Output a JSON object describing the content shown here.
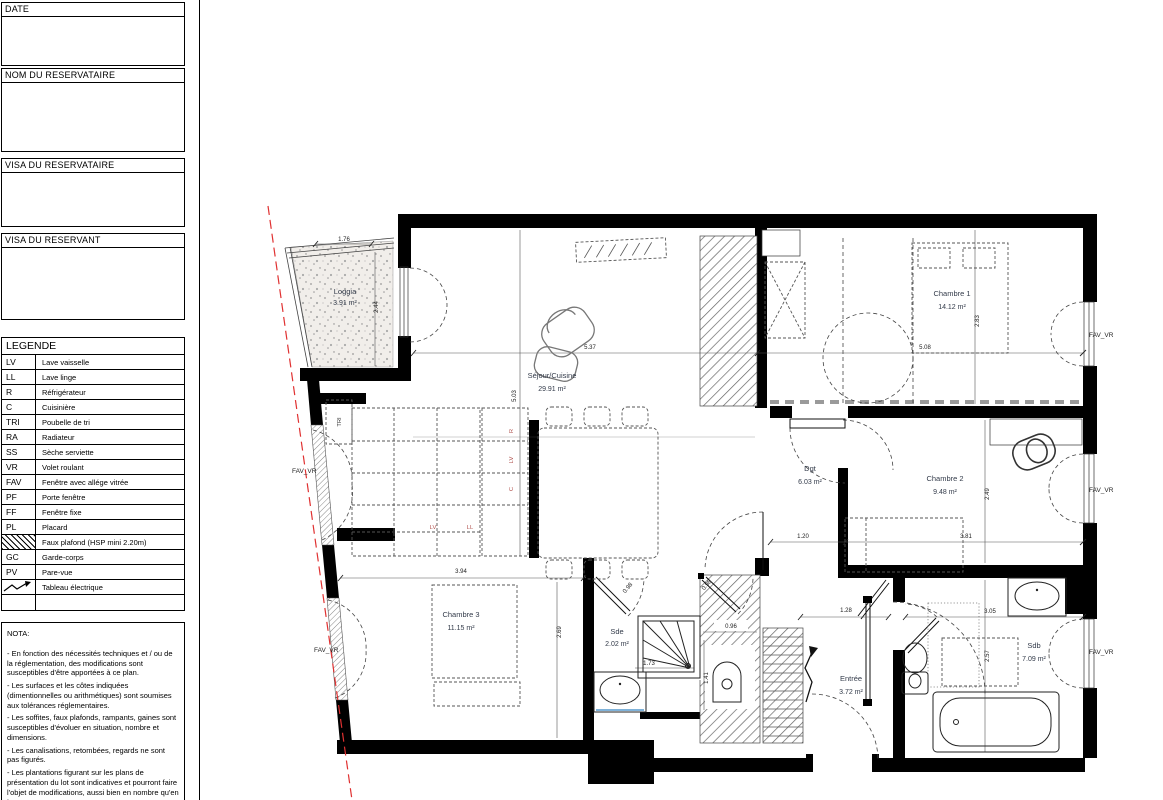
{
  "title_block": {
    "sections": [
      {
        "label": "DATE"
      },
      {
        "label": "NOM DU RESERVATAIRE"
      },
      {
        "label": "VISA DU RESERVATAIRE"
      },
      {
        "label": "VISA DU RESERVANT"
      }
    ]
  },
  "legend": {
    "title": "LEGENDE",
    "items": [
      {
        "code": "LV",
        "label": "Lave vaisselle"
      },
      {
        "code": "LL",
        "label": "Lave linge"
      },
      {
        "code": "R",
        "label": "Réfrigérateur"
      },
      {
        "code": "C",
        "label": "Cuisinière"
      },
      {
        "code": "TRI",
        "label": "Poubelle de tri"
      },
      {
        "code": "RA",
        "label": "Radiateur"
      },
      {
        "code": "SS",
        "label": "Sèche serviette"
      },
      {
        "code": "VR",
        "label": "Volet roulant"
      },
      {
        "code": "FAV",
        "label": "Fenêtre avec allége vitrée"
      },
      {
        "code": "PF",
        "label": "Porte fenêtre"
      },
      {
        "code": "FF",
        "label": "Fenêtre fixe"
      },
      {
        "code": "PL",
        "label": "Placard"
      },
      {
        "code": "",
        "label": "Faux plafond (HSP mini 2.20m)"
      },
      {
        "code": "GC",
        "label": "Garde-corps"
      },
      {
        "code": "PV",
        "label": "Pare-vue"
      },
      {
        "code": "",
        "label": "Tableau électrique"
      },
      {
        "code": "",
        "label": ""
      }
    ]
  },
  "nota": {
    "title": "NOTA:",
    "lines": [
      "- En fonction des nécessités techniques et / ou de la réglementation, des modifications sont susceptibles d'être apportées à ce plan.",
      "- Les surfaces et les côtes indiquées (dimentionnelles ou arithmétiques) sont soumises aux tolérances réglementaires.",
      "- Les soffites, faux plafonds, rampants, gaines sont susceptibles d'évoluer en situation, nombre et dimensions.",
      "- Les canalisations, retombées, regards ne sont pas figurés.",
      "- Les plantations figurant sur les plans de présentation du lot sont indicatives et pourront faire l'objet de modifications, aussi bien en nombre qu'en type.",
      "- Des modifications mineures ou des aménagements de détails nécessaires pour des raisons d'ordre technique ou administratif"
    ]
  },
  "plan": {
    "rooms": [
      {
        "name": "Loggia",
        "area": "3.91 m²"
      },
      {
        "name": "Séjour/Cuisine",
        "area": "29.91 m²"
      },
      {
        "name": "Chambre 1",
        "area": "14.12 m²"
      },
      {
        "name": "Chambre 2",
        "area": "9.48 m²"
      },
      {
        "name": "Chambre 3",
        "area": "11.15 m²"
      },
      {
        "name": "Dgt",
        "area": "6.03 m²"
      },
      {
        "name": "Sde",
        "area": "2.02 m²"
      },
      {
        "name": "Sdb",
        "area": "7.09 m²"
      },
      {
        "name": "Entrée",
        "area": "3.72 m²"
      }
    ],
    "dims": {
      "loggia_w": "1.76",
      "loggia_d": "2.44",
      "sejour_w": "5.37",
      "sejour_d": "5.03",
      "ch1_d": "2.83",
      "ch1_w": "5.08",
      "ch2_d": "2.49",
      "ch2_w": "3.81",
      "dgt_w": "1.20",
      "ch3_w": "3.94",
      "ch3_d": "2.69",
      "sde_w": "1.73",
      "door_a": "0.98",
      "door_b": "0.98",
      "wc_w": "0.96",
      "wc_d": "1.41",
      "entree_w": "1.28",
      "sdb_w": "3.05",
      "sdb_d": "2.57"
    },
    "window_label": "FAV_VR",
    "appliances": {
      "tri": "TRI",
      "fridge": "R",
      "dishwasher": "LV",
      "cooker": "C",
      "dishwasher2": "LV",
      "washer": "LL"
    }
  },
  "colors": {
    "wall": "#000000",
    "property_line_red": "#e03131",
    "appliance_label": "#b0514d"
  }
}
